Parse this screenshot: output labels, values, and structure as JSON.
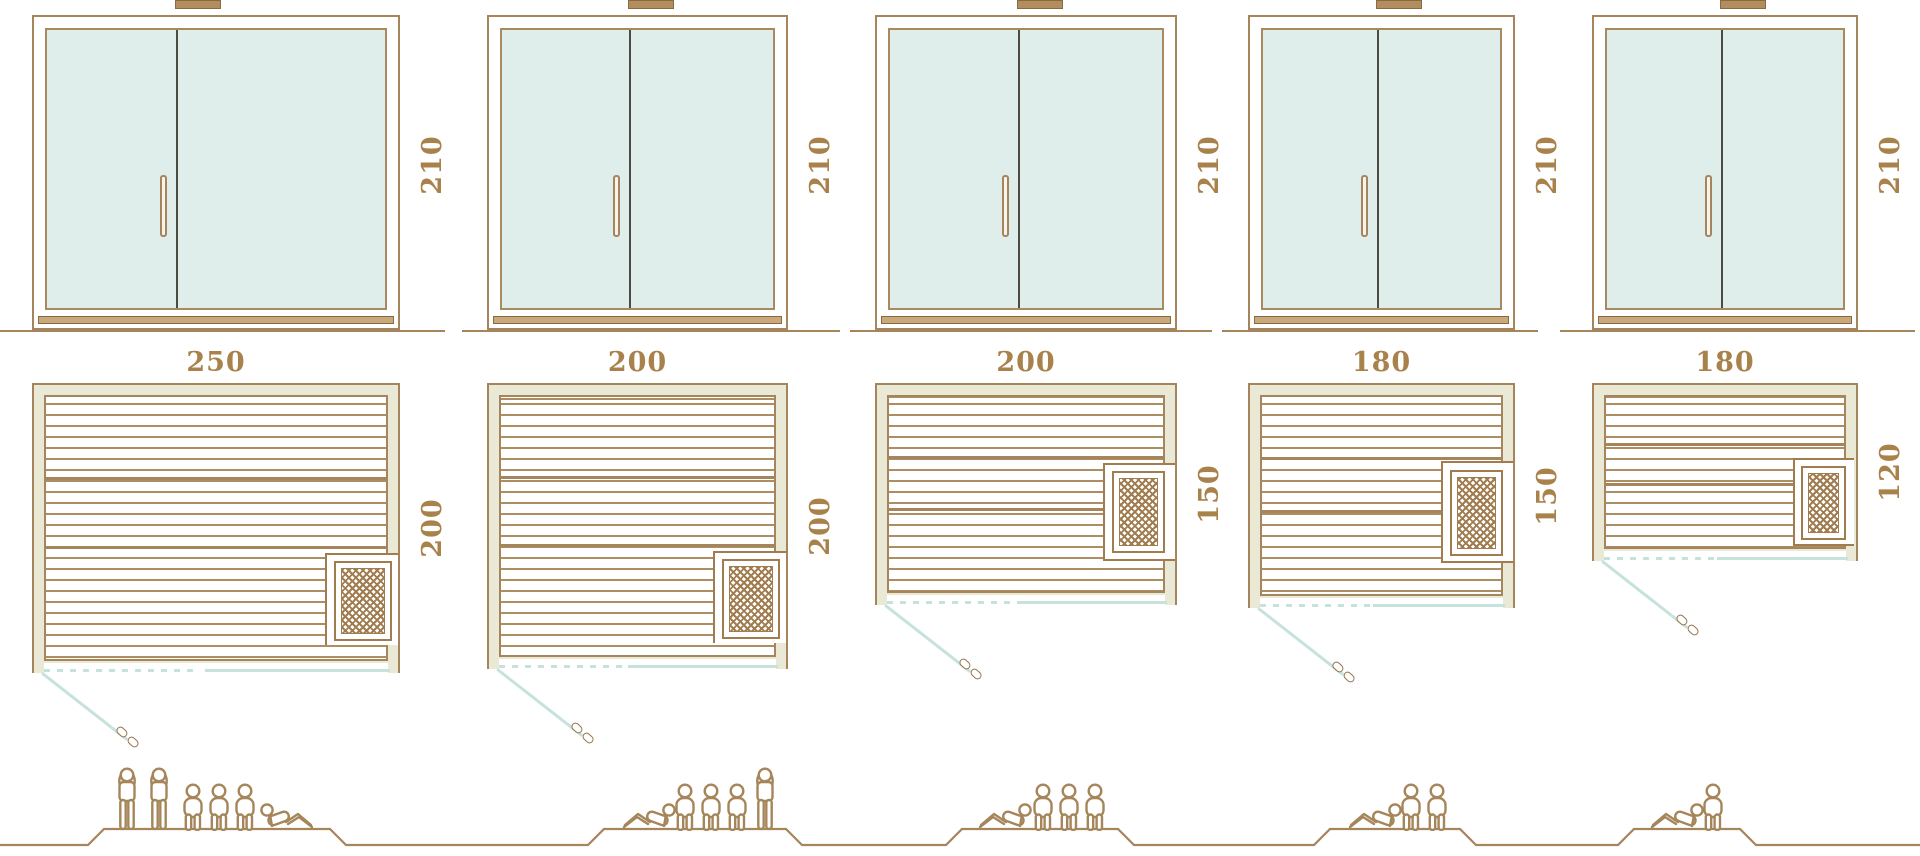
{
  "diagram_title": "Sauna size comparison diagram",
  "colors": {
    "line_brown": "#a6855c",
    "plank_brown": "#ad8d62",
    "text_brown": "#a8824a",
    "glass_teal": "#dfedeb",
    "frame_beige": "#e9e9d6",
    "swing_teal": "#c6e2dd",
    "divider_dark": "#4b4a43",
    "threshold_tan": "#c9a87c"
  },
  "saunas": [
    {
      "name": "sauna-250x200",
      "door_height": "210",
      "width": "250",
      "depth": "200",
      "capacity_total": 6,
      "figures": [
        "standing",
        "standing",
        "sitting",
        "sitting",
        "sitting",
        "lying"
      ]
    },
    {
      "name": "sauna-200x200",
      "door_height": "210",
      "width": "200",
      "depth": "200",
      "capacity_total": 5,
      "figures": [
        "lying",
        "sitting",
        "sitting",
        "sitting",
        "standing"
      ]
    },
    {
      "name": "sauna-200x150",
      "door_height": "210",
      "width": "200",
      "depth": "150",
      "capacity_total": 4,
      "figures": [
        "lying",
        "sitting",
        "sitting",
        "sitting"
      ]
    },
    {
      "name": "sauna-180x150",
      "door_height": "210",
      "width": "180",
      "depth": "150",
      "capacity_total": 3,
      "figures": [
        "lying",
        "sitting",
        "sitting"
      ]
    },
    {
      "name": "sauna-180x120",
      "door_height": "210",
      "width": "180",
      "depth": "120",
      "capacity_total": 2,
      "figures": [
        "lying",
        "sitting"
      ]
    }
  ]
}
